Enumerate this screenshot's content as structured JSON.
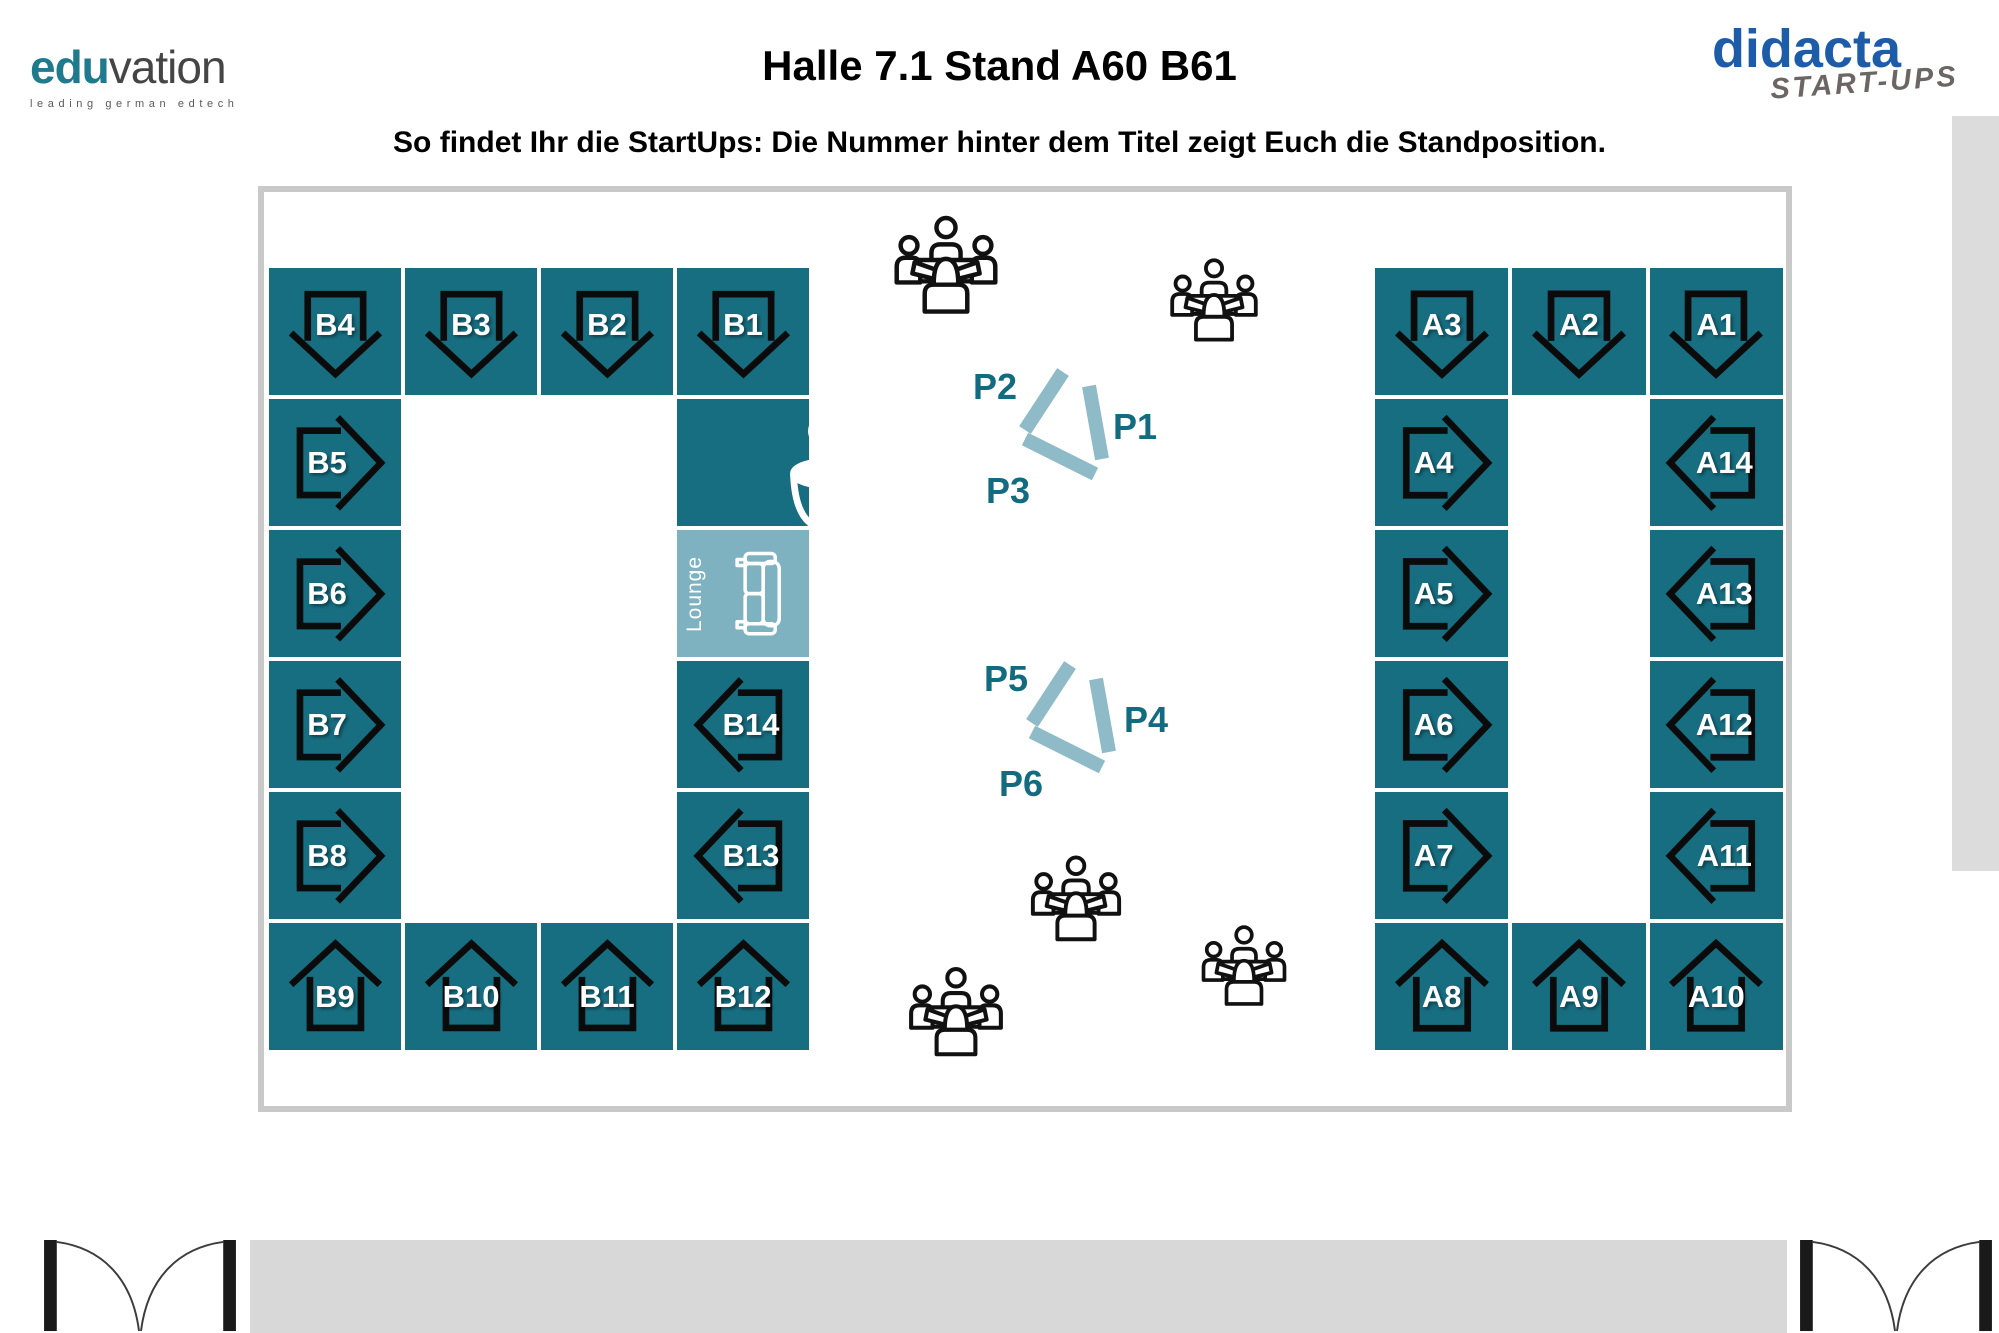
{
  "header": {
    "eduvation_logo": {
      "text_bold": "edu",
      "text_light": "vation",
      "tagline": "leading german edtech"
    },
    "title": "Halle 7.1 Stand A60 B61",
    "subtitle": "So findet Ihr die StartUps: Die Nummer hinter dem Titel zeigt Euch die Standposition.",
    "didacta_logo": {
      "name": "didacta",
      "sub": "START-UPS"
    }
  },
  "floorplan": {
    "b_block": [
      {
        "label": "B4",
        "arrow": "down"
      },
      {
        "label": "B3",
        "arrow": "down"
      },
      {
        "label": "B2",
        "arrow": "down"
      },
      {
        "label": "B1",
        "arrow": "down"
      },
      {
        "label": "B5",
        "arrow": "right"
      },
      {
        "label": "B6",
        "arrow": "right"
      },
      {
        "label": "B7",
        "arrow": "right"
      },
      {
        "label": "B8",
        "arrow": "right"
      },
      {
        "label": "B14",
        "arrow": "left"
      },
      {
        "label": "B13",
        "arrow": "left"
      },
      {
        "label": "B9",
        "arrow": "up"
      },
      {
        "label": "B10",
        "arrow": "up"
      },
      {
        "label": "B11",
        "arrow": "up"
      },
      {
        "label": "B12",
        "arrow": "up"
      }
    ],
    "a_block": [
      {
        "label": "A3",
        "arrow": "down"
      },
      {
        "label": "A2",
        "arrow": "down"
      },
      {
        "label": "A1",
        "arrow": "down"
      },
      {
        "label": "A4",
        "arrow": "right"
      },
      {
        "label": "A5",
        "arrow": "right"
      },
      {
        "label": "A6",
        "arrow": "right"
      },
      {
        "label": "A7",
        "arrow": "right"
      },
      {
        "label": "A14",
        "arrow": "left"
      },
      {
        "label": "A13",
        "arrow": "left"
      },
      {
        "label": "A12",
        "arrow": "left"
      },
      {
        "label": "A11",
        "arrow": "left"
      },
      {
        "label": "A8",
        "arrow": "up"
      },
      {
        "label": "A9",
        "arrow": "up"
      },
      {
        "label": "A10",
        "arrow": "up"
      }
    ],
    "amenities": {
      "lounge_label": "Lounge"
    },
    "podium_labels": {
      "p1": "P1",
      "p2": "P2",
      "p3": "P3",
      "p4": "P4",
      "p5": "P5",
      "p6": "P6"
    },
    "icons": [
      "coffee-cup-icon",
      "couch-icon",
      "meeting-people-icon",
      "down-arrow-icon",
      "up-arrow-icon",
      "left-arrow-icon",
      "right-arrow-icon",
      "open-book-icon"
    ]
  },
  "colors": {
    "booth_teal": "#176e81",
    "lounge_teal": "#7fb2c0",
    "podium_bar": "#8fbac7",
    "podium_label_teal": "#136b80",
    "eduvation_teal": "#1e7a8c",
    "didacta_blue": "#1d5ca9",
    "didacta_sub_gray": "#6b6563",
    "plan_frame_gray": "#c9c9c9",
    "bottom_bar_gray": "#d8d8d8",
    "scrollbar_gray": "#dcdcdc"
  }
}
